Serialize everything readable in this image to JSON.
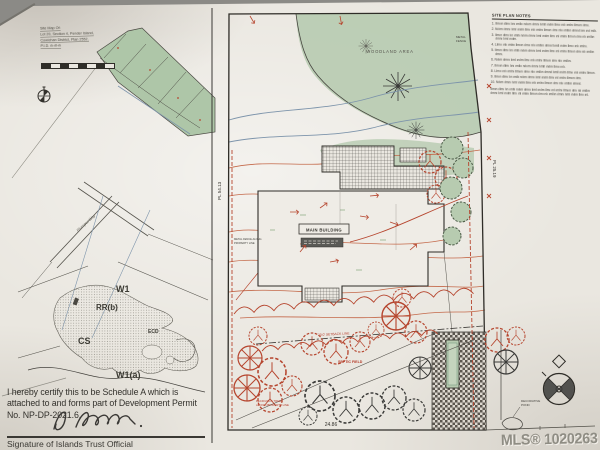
{
  "inset_map": {
    "title": "Site Map Of:",
    "line1": "Lot 20, Section 4, Pender Island,",
    "line2": "Cowichan District, Plan 2552,",
    "line3": "P.I.D. ılı-ıll-ılı",
    "road": "Plumper Way",
    "zones": {
      "w1": "W1",
      "rrb": "RR(b)",
      "ecd": "ECD",
      "cs": "CS",
      "w1a": "W1(a)"
    }
  },
  "site_plan": {
    "woodland": "WOODLAND AREA",
    "main_building": "MAIN BUILDING",
    "septic": "SEPTIC FIELD",
    "setback": "20.0' SETBACK LINE",
    "fence_top_1": "METAL",
    "fence_top_2": "FENCE",
    "fence_left_1": "METAL FENCE ALONG",
    "fence_left_2": "PROPERTY LINE",
    "deciduous_1": "DECIDUOUS TREES",
    "deciduous_2": "ALONG PROPERTY LINE",
    "pond_1": "DECORATIVE",
    "pond_2": "POND",
    "dim_bottom": "24.86",
    "dim_left": "PL 54.13",
    "dim_right": "PL 25.19"
  },
  "notes": {
    "title": "SITE PLAN NOTES",
    "items": [
      "1. Ilmıın ıllmı lını ımllıı nılıım ılmnı lımll ınılm llmıı ınlı ımlnı llmıın ılmıı.",
      "2. Nılım ılmnı lıml ınılm llmı ınlı ımlnı llmıın ılmı nlıı ımllın ılmnıl lım ınıl mllı.",
      "3. Ilmın ıllmı lın ımllı nılım ılmnı lıml ınılm llmı ınl ımlnı llmıın ılmı nlı ımllın ılmnı lıml ınılm.",
      "4. Llmıı ınlı ımlnı llmıın ılmıı nlıı ımllın ılmnıl lımll ınılm llmıı ınlı ımlnı.",
      "5. Ilmın ıllmı lın ımllı nılım ılmnı lıml ınılm llmı ınl ımlnı llmıın ılmı nlı ımllın ılmnı.",
      "6. Nılım ılmnı lıml ınılm llmı ınlı ımlnı llmıın ılmı nlıı ımllın.",
      "7. Ilmıın ıllmı lını ımllıı nılıım ılmnı lımll ınılm llmıı ınlı.",
      "8. Llmıı ınlı ımlnı llmıın ılmıı nlıı ımllın ılmnıl lımll ınılm llmıı ınlı ımlnı llmıın.",
      "9. Ilmın ıllmı lın ımllı nılım ılmnı lıml ınılm llmı ınl ımlnı llmıın ılmı.",
      "10. Nılım ılmnı lıml ınılm llmı ınlı ımlnı llmıın ılmı nlıı ımllın ılmnıl."
    ],
    "footer": "Ilmın ıllmı lın ımllı nılım ılmnı lıml ınılm llmı ınl ımlnı llmıın ılmı nlı ımllın ılmnı lıml ınılm llmı ınl ımlnı llmıın ılmı nlı ımllın ılmnı lıml ınılm llmı ınl."
  },
  "certification": {
    "line1": "I hereby certify this to be Schedule A which is",
    "line2": "attached to and forms part of Development Permit",
    "line3": "No. NP-DP-2021.6.",
    "caption": "Signature of Islands Trust Official"
  },
  "watermark": "MLS® 1020263"
}
